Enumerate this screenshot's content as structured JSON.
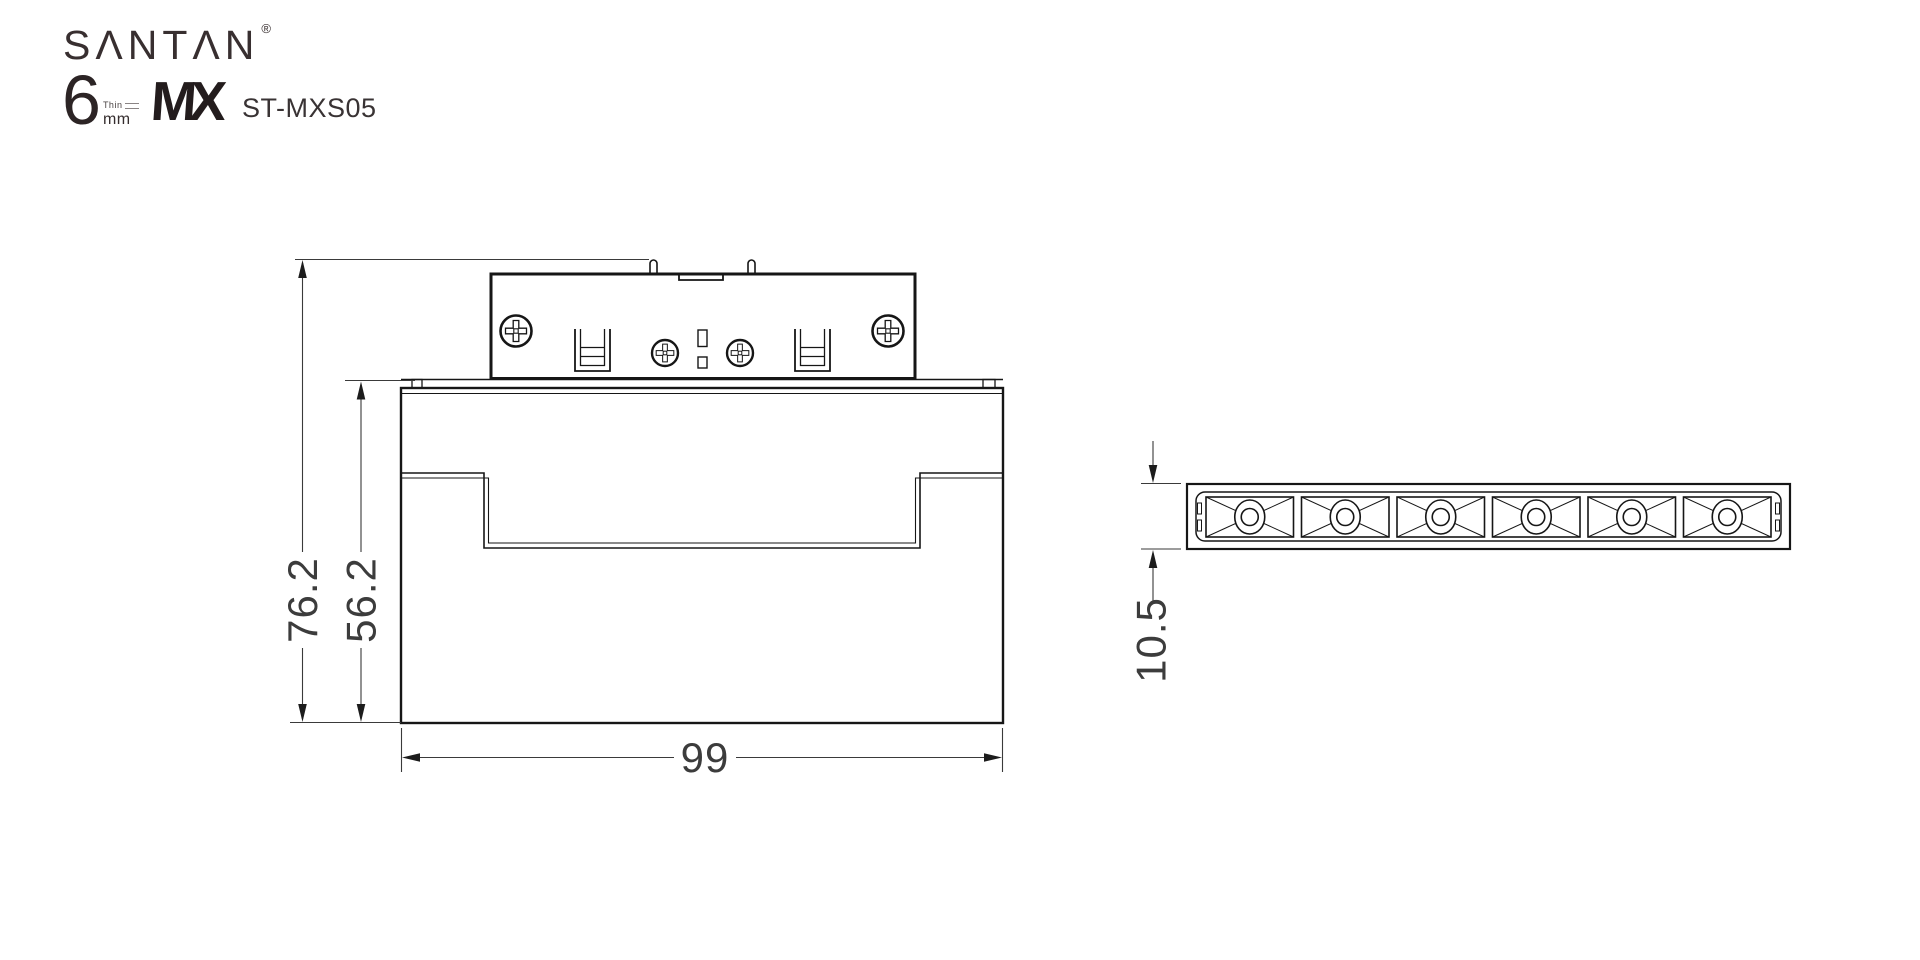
{
  "brand": {
    "name": "SANTAN",
    "display": "SΛNTΛN",
    "registered_mark": "®",
    "size_number": "6",
    "thin_label": "Thin",
    "unit_label": "mm",
    "series_logo": "MX",
    "model": "ST-MXS05"
  },
  "front_view": {
    "total_height": "76.2",
    "body_height": "56.2",
    "width": "99"
  },
  "bottom_view": {
    "height": "10.5",
    "led_cells": 6
  },
  "colors": {
    "object_line": "#161616",
    "dimension_line": "#3a3a3a",
    "background": "#ffffff"
  }
}
